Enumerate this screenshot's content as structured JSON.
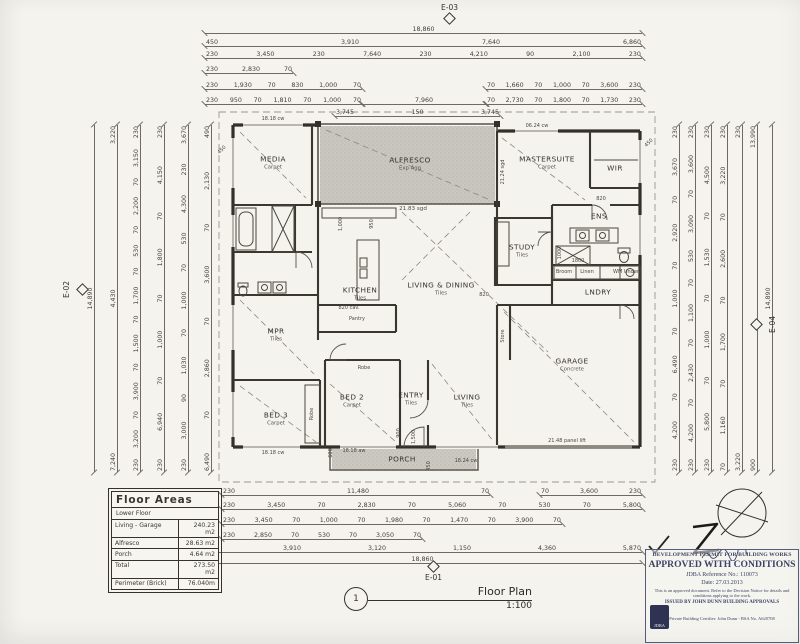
{
  "sheet": {
    "bg": "#f4f3ee",
    "ink": "#35322b",
    "shade": "#c9c7c0"
  },
  "elevation_markers": {
    "top": "E-03",
    "bottom": "E-01",
    "left": "E-02",
    "right": "E-04"
  },
  "drawing_title": {
    "number": "1",
    "name": "Floor Plan",
    "scale": "1:100"
  },
  "floor_areas": {
    "title": "Floor Areas",
    "subtitle": "Lower Floor",
    "rows": [
      {
        "label": "Living - Garage",
        "value": "240.23 m2"
      },
      {
        "label": "Alfresco",
        "value": "28.63 m2"
      },
      {
        "label": "Porch",
        "value": "4.64 m2"
      },
      {
        "label": "Total",
        "value": "273.50 m2"
      },
      {
        "label": "Perimeter (Brick)",
        "value": "76.040m"
      }
    ]
  },
  "stamp": {
    "line1": "DEVELOPMENT PERMIT FOR BUILDING WORKS",
    "line2": "APPROVED WITH CONDITIONS",
    "reference": "JDBA Reference No.: 110073",
    "date": "Date: 27.03.2013",
    "note": "This is an approved document. Refer to the Decision Notice for details and conditions applying to the work.",
    "issued": "ISSUED BY JOHN DUNN BUILDING APPROVALS",
    "certifier": "Private Building Certifier: John Dunn - BSA No. A620708",
    "logo": "JDBA"
  },
  "rooms": [
    {
      "name": "MEDIA",
      "sub": "Carpet"
    },
    {
      "name": "ALFRESCO",
      "sub": "Exp Agg"
    },
    {
      "name": "MASTERSUITE",
      "sub": "Carpet"
    },
    {
      "name": "WIR",
      "sub": ""
    },
    {
      "name": "ENS",
      "sub": ""
    },
    {
      "name": "STUDY",
      "sub": "Tiles"
    },
    {
      "name": "KITCHEN",
      "sub": "Tiles"
    },
    {
      "name": "LIVING & DINING",
      "sub": "Tiles"
    },
    {
      "name": "LNDRY",
      "sub": ""
    },
    {
      "name": "GARAGE",
      "sub": "Concrete"
    },
    {
      "name": "MPR",
      "sub": "Tiles"
    },
    {
      "name": "BED 3",
      "sub": "Carpet"
    },
    {
      "name": "BED 2",
      "sub": "Carpet"
    },
    {
      "name": "ENTRY",
      "sub": "Tiles"
    },
    {
      "name": "LIVING",
      "sub": "Tiles"
    },
    {
      "name": "PORCH",
      "sub": ""
    }
  ],
  "ann": {
    "media_win": "18.18 cw",
    "master_win": "06.24 cw",
    "alf_note": "21.83 sgd",
    "alf_side": "21.24 sgd",
    "porch_win": "18.18 aw",
    "bed3_win": "18.18 cw",
    "living_win": "18.24 cw",
    "garage_door": "21.48 panel lift",
    "pantry": "Pantry",
    "robe_bed2": "Robe",
    "robe_bed3": "Robe",
    "store": "Store",
    "broom": "Broom",
    "linen": "Linen",
    "wm": "WM Under",
    "d950": "950",
    "d1000": "1,000",
    "d820a": "820",
    "d820b": "820",
    "d820cav": "820 cav.",
    "d900": "900",
    "d1500": "1,500",
    "d600": "600",
    "d450": "450",
    "shower1800": "1800",
    "ens1000": "1000",
    "eave1": "450",
    "eave2": "450"
  },
  "dims": {
    "t_total": "18,860",
    "t1": [
      "450",
      "3,910",
      "7,640",
      "6,860"
    ],
    "t2": [
      "230",
      "3,450",
      "230",
      "7,640",
      "230",
      "4,210",
      "90",
      "2,100",
      "230"
    ],
    "t3": [
      "230",
      "2,830",
      "70"
    ],
    "t4l": [
      "230",
      "1,930",
      "70",
      "830",
      "1,000",
      "70"
    ],
    "t4r": [
      "70",
      "1,660",
      "70",
      "1,000",
      "70",
      "3,600",
      "230"
    ],
    "t5l": [
      "230",
      "950",
      "70",
      "1,810",
      "70",
      "1,000",
      "70"
    ],
    "t5m": [
      "7,960"
    ],
    "t5r": [
      "70",
      "2,730",
      "70",
      "1,800",
      "70",
      "1,730",
      "230"
    ],
    "t6": [
      "3,745",
      "150",
      "3,745"
    ],
    "b1l": [
      "230",
      "11,480",
      "70"
    ],
    "b1r": [
      "70",
      "3,600",
      "230"
    ],
    "b2": [
      "230",
      "3,450",
      "70",
      "2,830",
      "70",
      "5,060",
      "70",
      "530",
      "70",
      "5,800"
    ],
    "b3": [
      "230",
      "3,450",
      "70",
      "1,000",
      "70",
      "1,980",
      "70",
      "1,470",
      "70",
      "3,900",
      "70"
    ],
    "b4": [
      "230",
      "2,850",
      "70",
      "530",
      "70",
      "3,050",
      "70"
    ],
    "b5": [
      "450",
      "3,910",
      "3,120",
      "1,150",
      "4,360",
      "5,870"
    ],
    "b_total": "18,860",
    "l1": [
      "14,890"
    ],
    "l2": [
      "3,220",
      "4,430",
      "7,240"
    ],
    "l3": [
      "230",
      "3,150",
      "70",
      "2,200",
      "70",
      "530",
      "70",
      "1,700",
      "70",
      "1,500",
      "70",
      "3,900",
      "70",
      "3,200",
      "230"
    ],
    "l4": [
      "230",
      "4,150",
      "70",
      "1,800",
      "70",
      "1,000",
      "70",
      "6,940",
      "230"
    ],
    "l5": [
      "3,670",
      "230",
      "4,300",
      "530",
      "70",
      "1,000",
      "70",
      "1,030",
      "90",
      "3,000",
      "230"
    ],
    "l6": [
      "490",
      "2,130",
      "70",
      "3,600",
      "70",
      "2,860",
      "70",
      "6,490"
    ],
    "r1": [
      "230",
      "3,670",
      "70",
      "2,920",
      "70",
      "1,000",
      "70",
      "6,490",
      "70",
      "4,200",
      "230"
    ],
    "r2": [
      "230",
      "3,600",
      "70",
      "3,090",
      "530",
      "70",
      "1,100",
      "70",
      "2,430",
      "70",
      "4,200",
      "230"
    ],
    "r3": [
      "230",
      "4,500",
      "70",
      "1,530",
      "70",
      "1,000",
      "70",
      "5,800",
      "230"
    ],
    "r4": [
      "230",
      "3,220",
      "70",
      "2,600",
      "70",
      "1,700",
      "70",
      "1,160",
      "70"
    ],
    "r5": [
      "230",
      "3,220"
    ],
    "r6": [
      "13,990",
      "900"
    ],
    "r7": [
      "14,890"
    ]
  }
}
